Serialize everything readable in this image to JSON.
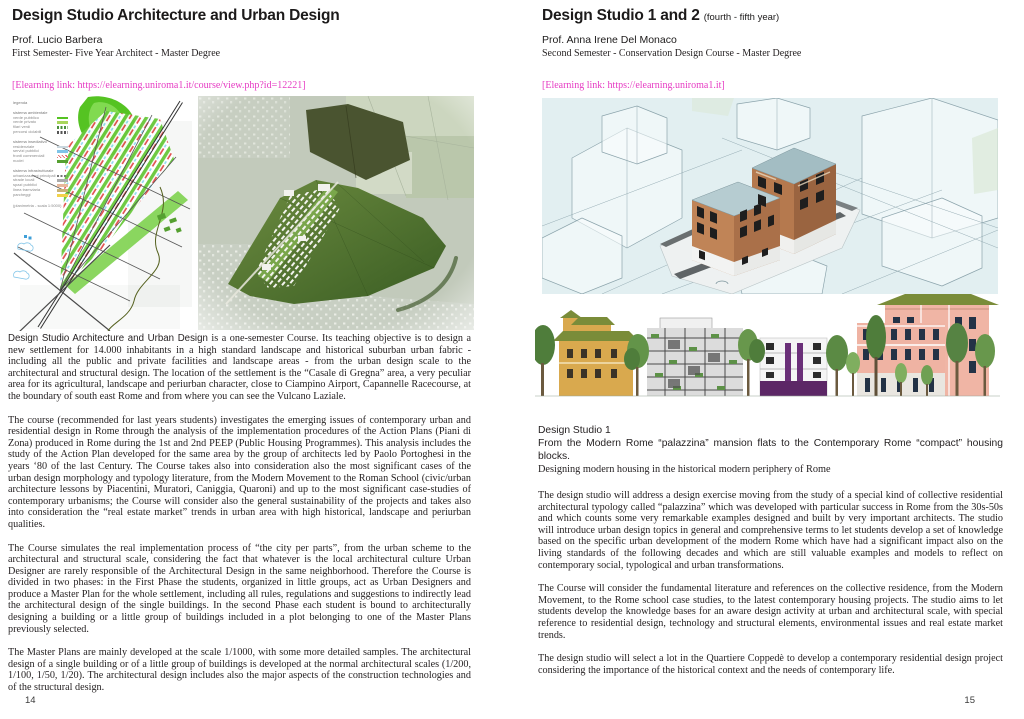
{
  "colors": {
    "link": "#e63bc3",
    "text": "#231f20",
    "title": "#1c1a1a"
  },
  "pages": {
    "left": {
      "title": "Design Studio Architecture and Urban Design",
      "professor": "Prof. Lucio Barbera",
      "course_info": "First Semester-  Five Year Architect - Master Degree",
      "elearning_link": "[Elearning link: https://elearning.uniroma1.it/course/view.php?id=12221]",
      "page_number": "14",
      "figure_legend": {
        "title": "legenda",
        "groups": [
          {
            "header": "sistema ambientale",
            "items": [
              {
                "label": "verde pubblico",
                "color": "#55c322"
              },
              {
                "label": "verde privato",
                "color": "#a8d65c"
              },
              {
                "label": "filari verdi",
                "color": "#4a8f3c",
                "style": "dash"
              },
              {
                "label": "percorsi ciclabili",
                "color": "#555555",
                "style": "dash"
              }
            ]
          },
          {
            "header": "sistema insediativo",
            "items": [
              {
                "label": "residenziale",
                "color": "#c9d6dd"
              },
              {
                "label": "servizi pubblici",
                "color": "#7fc4e8"
              },
              {
                "label": "fronti commerciali",
                "color": "#e04848",
                "style": "hatch"
              },
              {
                "label": "nuclei",
                "color": "#55a030"
              }
            ]
          },
          {
            "header": "sistema infrastrutturale",
            "items": [
              {
                "label": "urbanizzazioni principali",
                "color": "#777777",
                "style": "dash"
              },
              {
                "label": "strade locali",
                "color": "#aaaaaa"
              },
              {
                "label": "spazi pubblici",
                "color": "#e8b89a"
              },
              {
                "label": "linea tramviaria",
                "color": "#c8b277"
              },
              {
                "label": "parcheggi",
                "color": "#f2d24b"
              }
            ]
          }
        ],
        "footer": "(planimetria - scala 1:5000)"
      },
      "paragraphs": [
        {
          "lead": "Design Studio Architecture and Urban Design",
          "rest": " is a one-semester Course. Its teaching objective is to design a new settlement for 14.000 inhabitants in a high standard landscape and historical suburban urban fabric - including all the public and private facilities and landscape areas - from the urban design scale to the architectural and structural design. The location of the settlement is the “Casale di Gregna” area, a very peculiar area for its agricultural, landscape and periurban character, close to Ciampino Airport, Capannelle Racecourse, at the boundary of south east Rome and from where you can see the Vulcano Laziale."
        },
        "The course (recommended for last years students) investigates the emerging issues of contemporary urban and residential design in Rome through the analysis of the implementation procedures of the Action Plans (Piani di Zona) produced in Rome during the 1st and 2nd PEEP (Public Housing Programmes). This analysis includes the study of the Action Plan developed for the same area by the group of architects led by Paolo Portoghesi in the years ‘80 of the last Century. The Course takes also into consideration also the most significant cases of the urban design morphology and typology literature, from the Modern Movement to the Roman School (civic/urban architecture lessons by Piacentini, Muratori, Caniggia, Quaroni) and up to the most significant case-studies of contemporary urbanisms; the Course will consider also the general sustainability of the projects and takes also into consideration the “real estate market” trends in urban area with high historical, landscape and periurban qualities.",
        "The Course simulates the real implementation process of “the city per parts”, from the urban scheme to the architectural and structural scale, considering the fact that whatever is the local architectural culture Urban Designer are rarely responsible of the Architectural Design in the same neighborhood. Therefore the Course is divided in two phases: in the First Phase the students, organized in little groups, act as Urban Designers and produce a Master Plan for the whole settlement, including all rules, regulations and suggestions to indirectly lead the architectural design of the single buildings. In the second Phase each student is bound to architecturally designing a building or a little group of buildings included in a plot belonging to one of the Master Plans previously selected.",
        "The Master Plans are mainly developed at the scale 1/1000, with some more detailed samples. The architectural design of a single building or of a little group of buildings is developed at the normal architectural scales (1/200, 1/100, 1/50, 1/20). The architectural design includes also the major aspects of the construction technologies and of the structural design."
      ]
    },
    "right": {
      "title": "Design Studio 1 and 2",
      "title_suffix": "(fourth - fifth year)",
      "professor": "Prof. Anna Irene Del Monaco",
      "course_info": "Second Semester - Conservation Design Course - Master Degree",
      "elearning_link": "[Elearning link: https://elearning.uniroma1.it]",
      "page_number": "15",
      "section": {
        "heading": "Design Studio 1",
        "subtitle_line1": "From the Modern Rome “palazzina” mansion flats to the Contemporary Rome “compact” housing blocks.",
        "subtitle_line2": "Designing modern housing in the historical modern periphery of Rome"
      },
      "paragraphs": [
        "The design studio will address a design exercise moving from the study of a special kind of collective residential architectural typology called “palazzina” which was developed with particular success in Rome from the 30s-50s and which counts some very remarkable examples designed and built by very important architects. The studio will introduce urban design topics in general and comprehensive terms to let students develop a set of knowledge based on the specific urban development of the modern Rome which have had a significant impact also on the living standards of the following decades and which are still valuable examples and models to reflect on contemporary social, typological and urban transformations.",
        "The Course will consider the fundamental literature and references on the collective residence, from the Modern Movement, to the Rome school case studies, to the latest contemporary housing projects. The studio aims to let students develop the knowledge bases for an aware design activity at urban and architectural scale, with special reference to residential design, technology and structural elements, environmental issues and real estate market trends.",
        "The design studio will select a lot in the Quartiere Coppedè to develop a contemporary residential design project considering the importance of the historical context and the needs of contemporary life."
      ]
    }
  }
}
